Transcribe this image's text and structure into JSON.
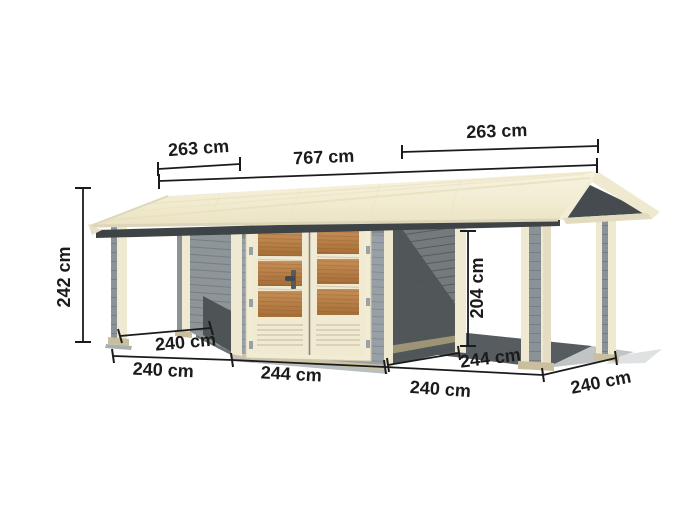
{
  "diagram": {
    "type": "product-dimension-diagram",
    "labels": {
      "roof_section_left": "263 cm",
      "roof_total": "767 cm",
      "roof_section_right": "263 cm",
      "total_height": "242 cm",
      "clearance_height": "204 cm",
      "left_canopy_depth": "240 cm",
      "left_canopy_width": "240 cm",
      "shed_front_width": "244 cm",
      "shed_side_depth": "244 cm",
      "right_canopy_width": "240 cm",
      "right_canopy_depth": "240 cm"
    },
    "colors": {
      "background": "#ffffff",
      "roof_cream": "#f2edd8",
      "roof_fascia": "#ded7bc",
      "under_roof_band": "#3e4345",
      "gable_shadow": "#454b4e",
      "wall_front_gray": "#99a0a5",
      "wall_side_gray": "#6f7577",
      "wall_shadow": "#4e5456",
      "trim_cream": "#efe9d1",
      "post_stripe_gray": "#8b9297",
      "door_frame_cream": "#f2ecd5",
      "door_wood": "#b9824c",
      "ground_shadow": "#5a6063",
      "dimension_line": "#1b1b1b"
    }
  }
}
